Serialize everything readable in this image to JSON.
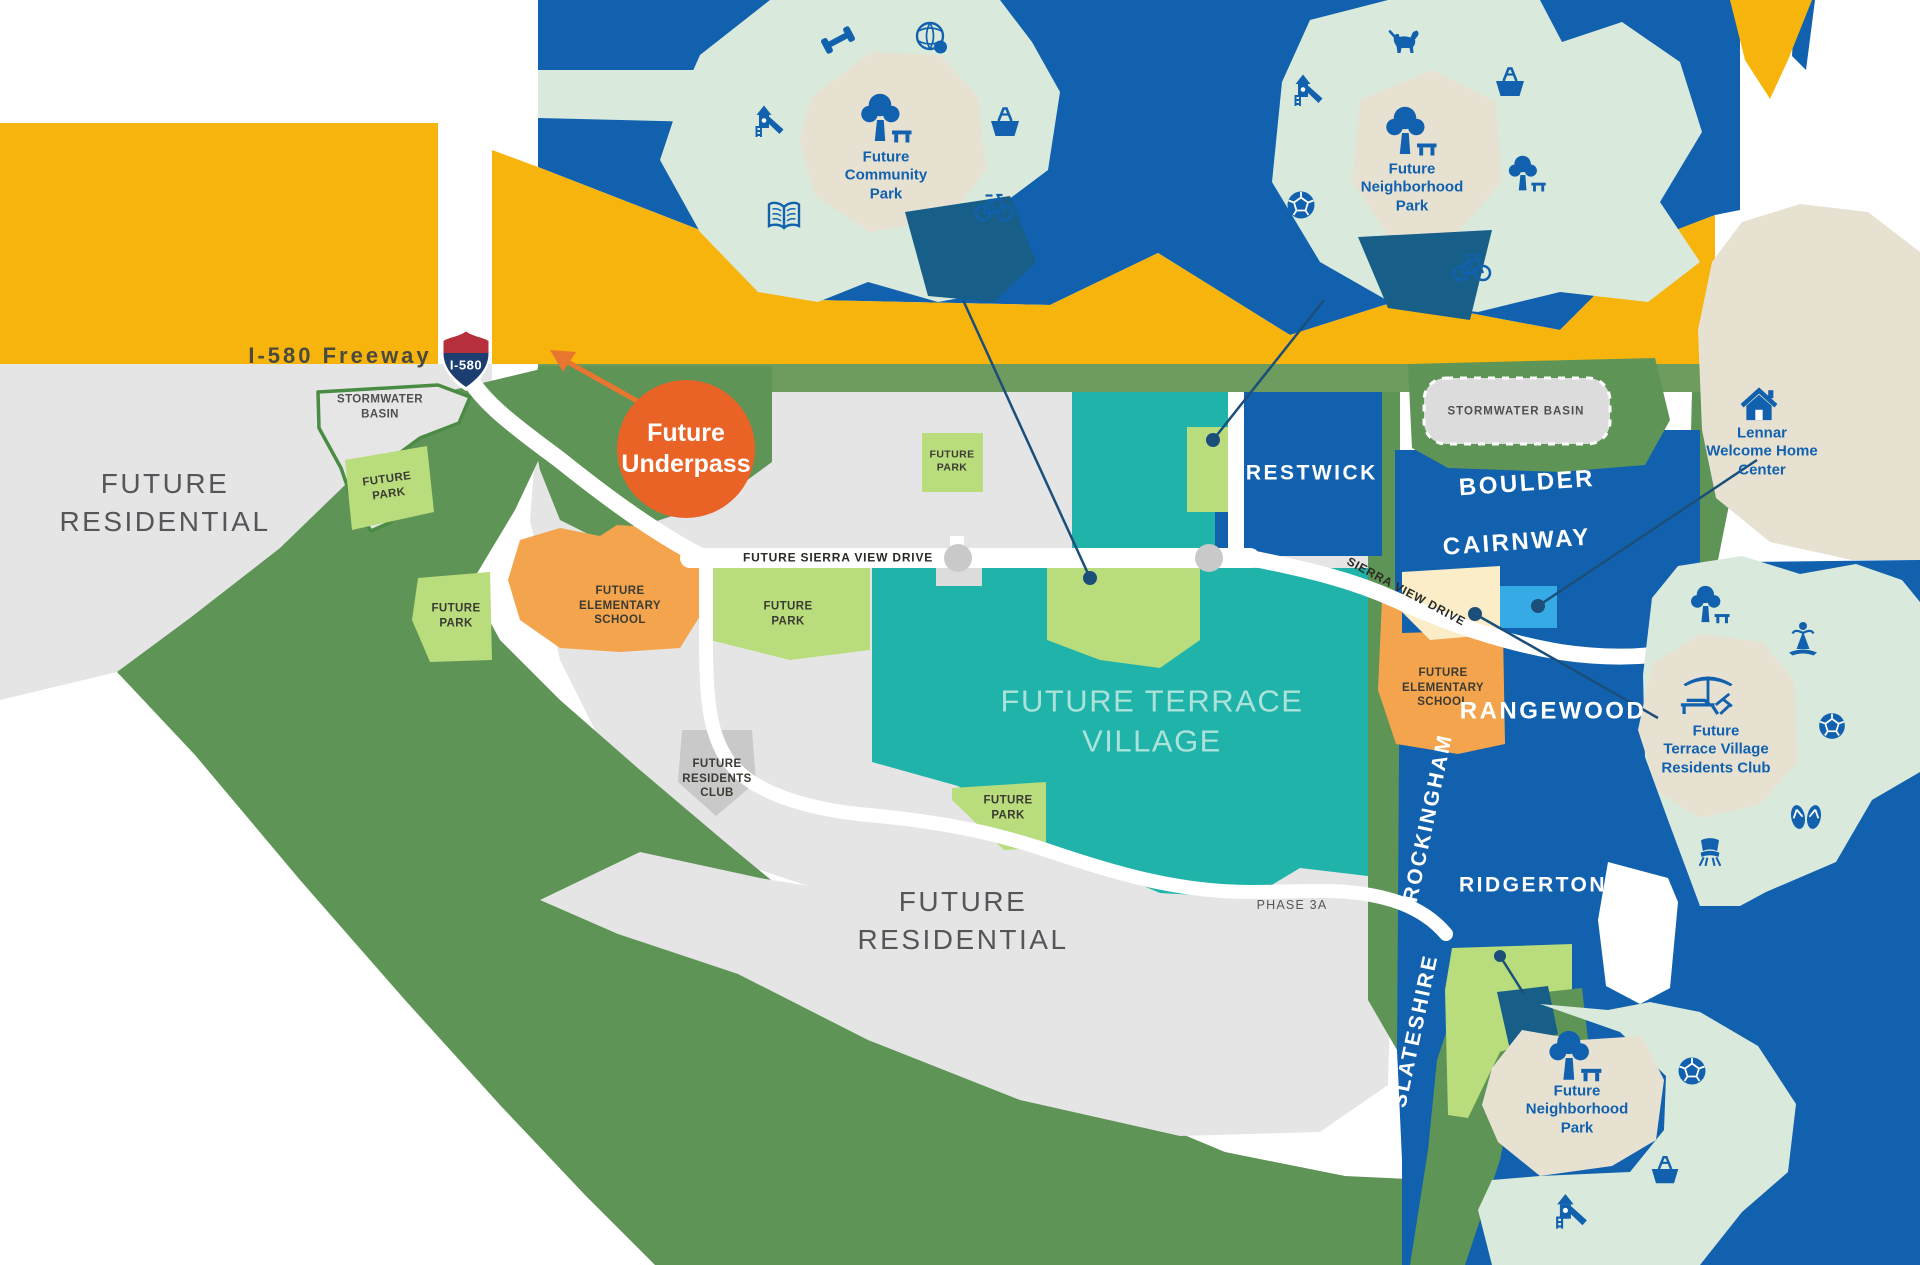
{
  "labels": {
    "freeway": "I-580 Freeway",
    "shield": "I-580",
    "underpass_lines": [
      "Future",
      "Underpass"
    ],
    "future_residential_lines": [
      "FUTURE",
      "RESIDENTIAL"
    ],
    "future_park_lines": [
      "FUTURE",
      "PARK"
    ],
    "future_elementary_school_lines": [
      "FUTURE",
      "ELEMENTARY",
      "SCHOOL"
    ],
    "stormwater_basin": "STORMWATER BASIN",
    "stormwater_basin_lines": [
      "STORMWATER",
      "BASIN"
    ],
    "future_sierra_view_drive": "FUTURE SIERRA VIEW DRIVE",
    "sierra_view_drive": "SIERRA VIEW DRIVE",
    "future_terrace_village_lines": [
      "FUTURE TERRACE",
      "VILLAGE"
    ],
    "future_residents_club_lines": [
      "FUTURE",
      "RESIDENTS",
      "CLUB"
    ],
    "phase": "PHASE 3A",
    "community_park_lines": [
      "Future",
      "Community",
      "Park"
    ],
    "neighborhood_park_lines": [
      "Future",
      "Neighborhood",
      "Park"
    ],
    "lennar_lines": [
      "Lennar",
      "Welcome Home",
      "Center"
    ],
    "residents_club_lines": [
      "Future",
      "Terrace Village",
      "Residents Club"
    ]
  },
  "neighborhoods": {
    "crestwick": "CRESTWICK",
    "boulder": "BOULDER",
    "cairnway": "CAIRNWAY",
    "rangewood": "RANGEWOOD",
    "rockingham": "ROCKINGHAM",
    "ridgerton": "RIDGERTON",
    "slateshire": "SLATESHIRE"
  },
  "amenity_icons": [
    "dumbbell-icon",
    "globe-icon",
    "playground-icon",
    "picnic-basket-icon",
    "book-icon",
    "bicycle-icon",
    "tree-bench-icon",
    "dog-icon",
    "soccer-ball-icon",
    "house-icon",
    "umbrella-lounge-icon",
    "yoga-icon",
    "flip-flops-icon",
    "chair-icon"
  ],
  "colors": {
    "c_yellow": "#F6B40D",
    "c_blue": "#1161AE",
    "c_navy": "#175E89",
    "c_teal": "#1FB3A9",
    "c_mint": "#D9EADC",
    "c_beige": "#E7E1D2",
    "c_green": "#5E9456",
    "c_band": "#6E9B5E",
    "c_lgreen": "#B9DC7D",
    "c_orange": "#F4A44C",
    "c_cream": "#FAEDC8",
    "c_lblue": "#35AAE4",
    "c_upass": "#E96327",
    "c_arrow": "#E8762E",
    "c_gray": "#E5E5E5",
    "c_gray2": "#C9C9C9",
    "c_basin": "#DCDCDC",
    "c_outline": "#4A8C44",
    "c_leader": "#1B4E79",
    "c_shield_red": "#B5303B",
    "c_shield_blue": "#1C3E70"
  }
}
